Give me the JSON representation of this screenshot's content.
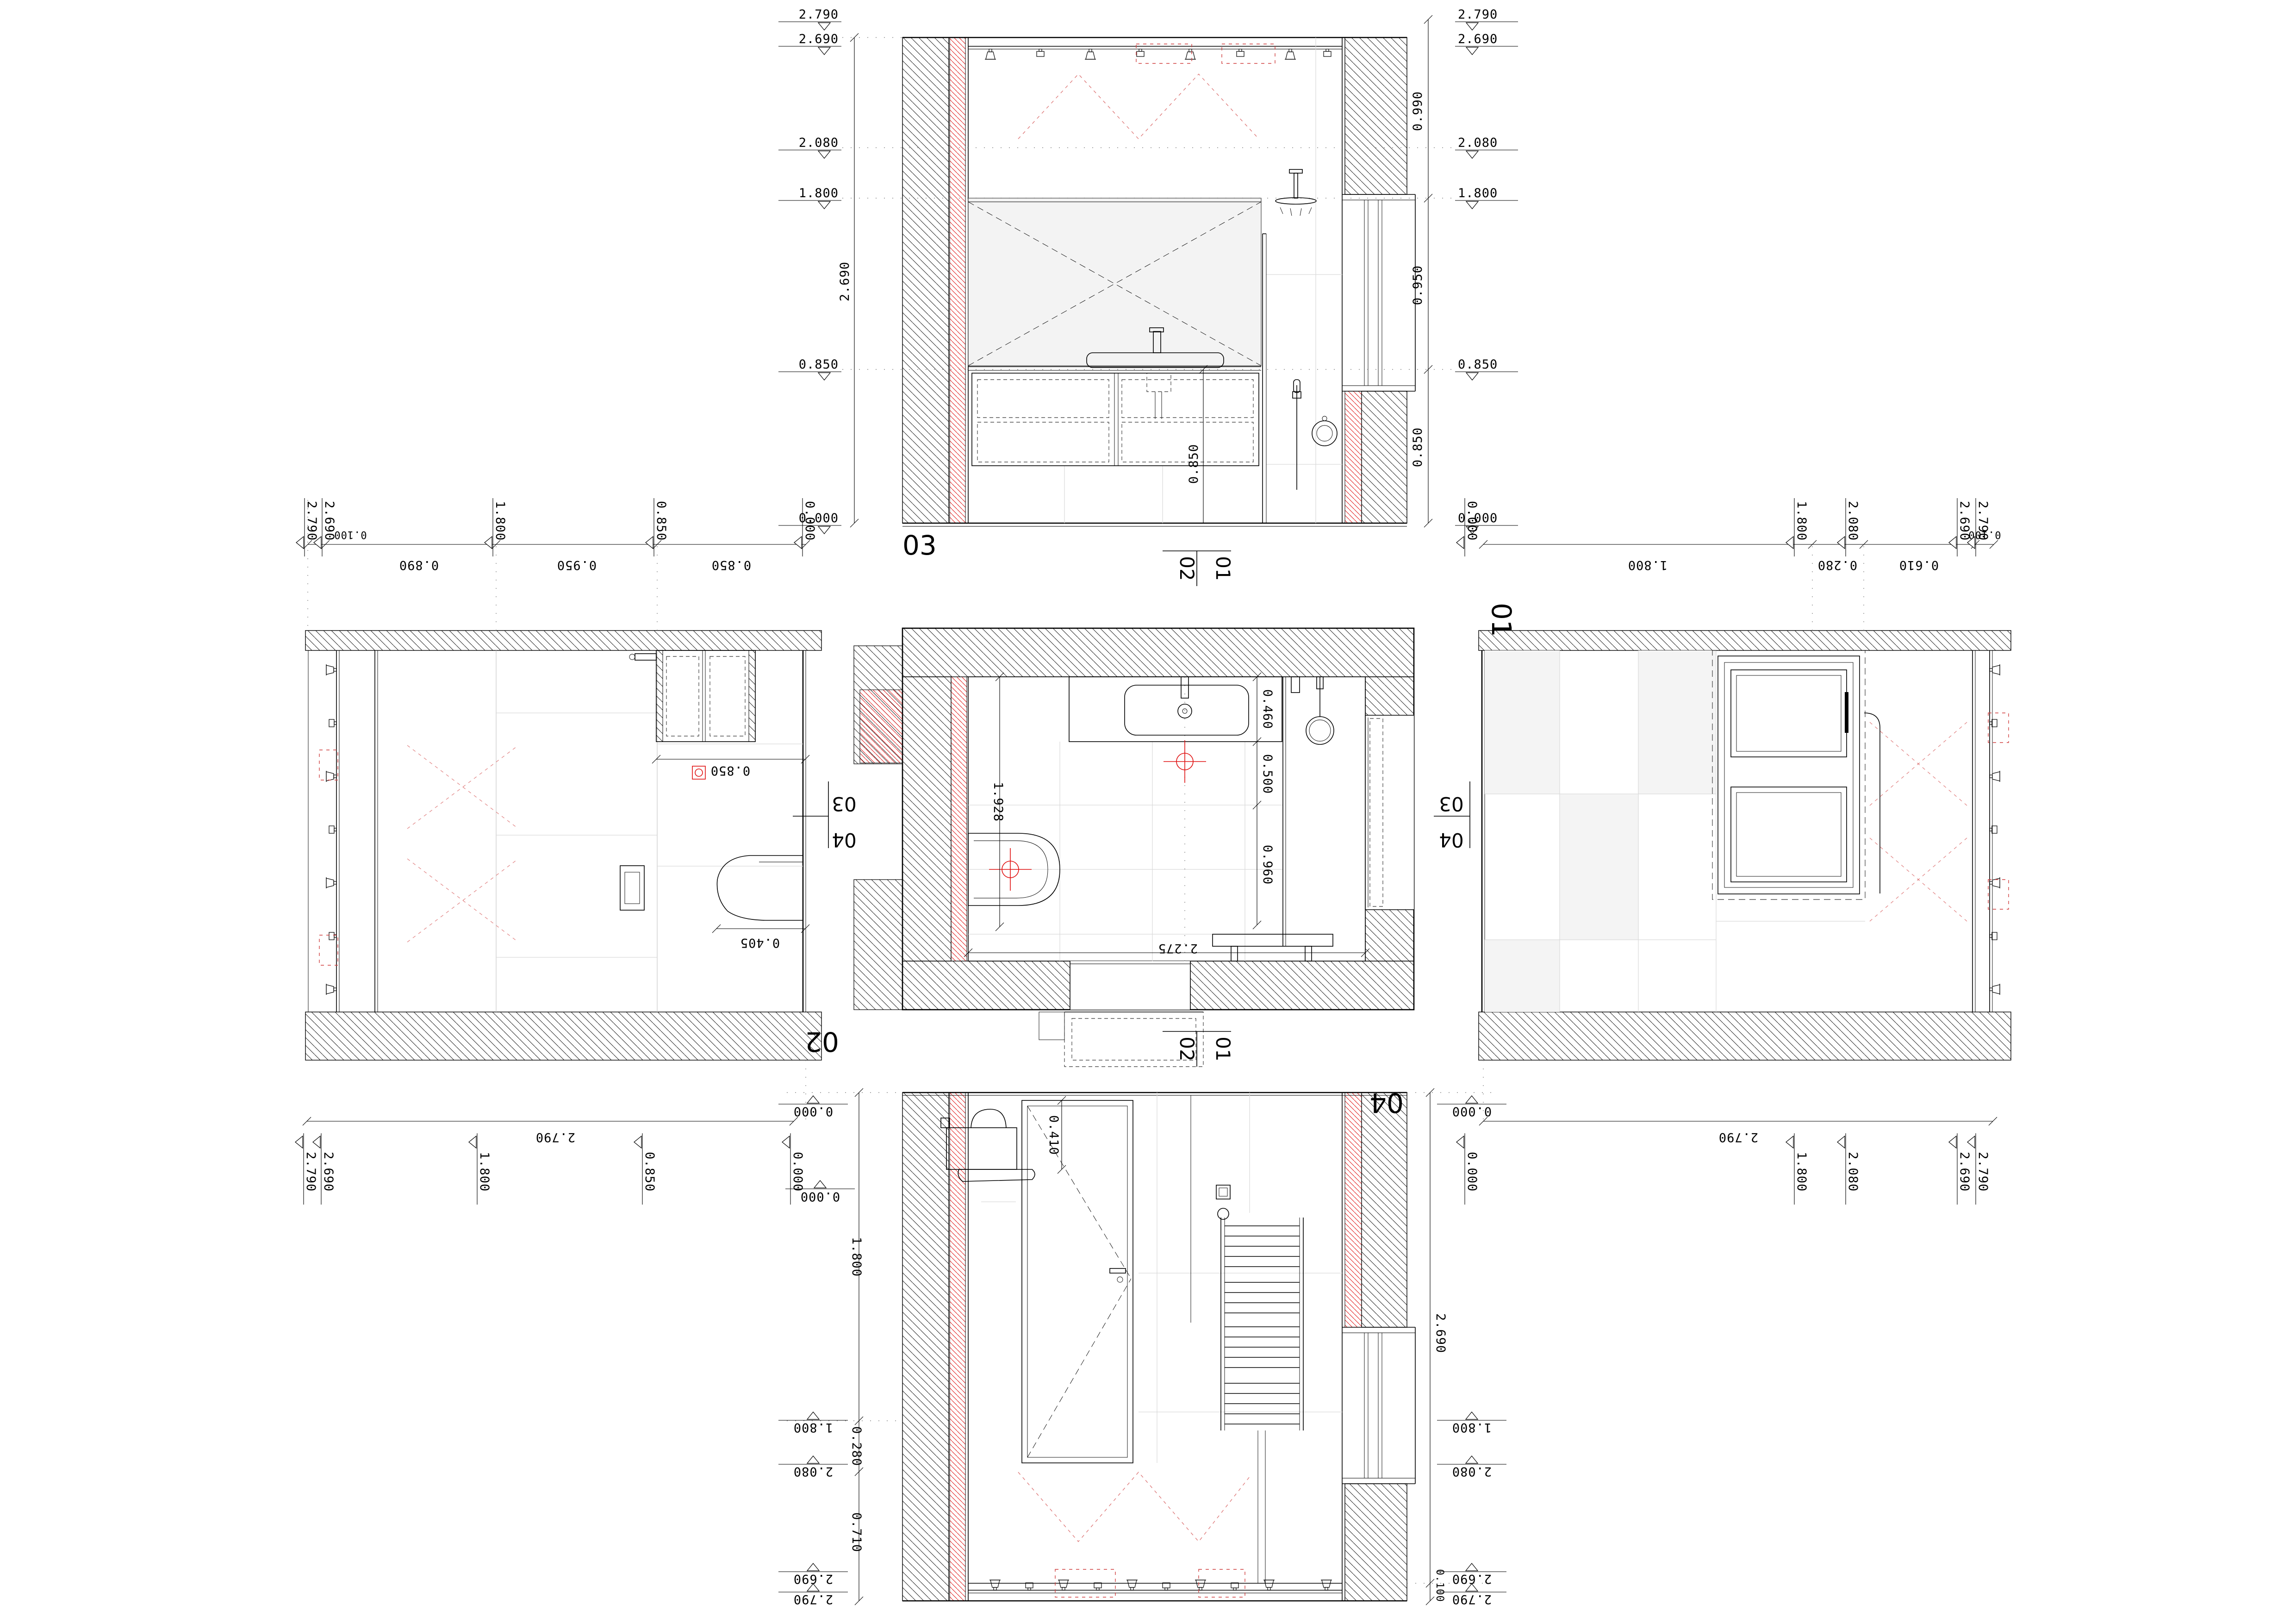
{
  "drawing": {
    "type": "bathroom floor plan with fold-out interior elevations",
    "colors": {
      "accent_red": "#e01010",
      "line_black": "#000000",
      "tile_joint": "#d9d9d9",
      "glass_fill": "#f3f3f3"
    }
  },
  "views": {
    "v03": {
      "label": "03",
      "left_levels": [
        "2.790",
        "2.690",
        "2.080",
        "1.800",
        "0.850",
        "0.000"
      ],
      "right_levels": [
        "2.790",
        "2.690",
        "2.080",
        "1.800",
        "0.850",
        "0.000"
      ],
      "height_dim": "2.690",
      "right_chain": [
        "0.990",
        "0.950",
        "0.850"
      ],
      "shower_dim": "0.850"
    },
    "plan": {
      "depth_chain": [
        "0.460",
        "0.500",
        "0.960"
      ],
      "wc_axis_dim": "1.928",
      "width_dim": "2.275",
      "floor_level": "0.000",
      "marker_h": [
        "02",
        "01"
      ],
      "marker_v": [
        "03",
        "04"
      ]
    },
    "v02": {
      "label": "02",
      "offset_dim": "0.100",
      "top_chain": [
        "0.890",
        "0.950",
        "0.850"
      ],
      "top_levels": [
        "2.790",
        "2.690",
        "1.800",
        "0.850",
        "0.000"
      ],
      "bottom_levels": [
        "2.790",
        "2.690",
        "1.800",
        "0.850",
        "0.000"
      ],
      "width_dim": "2.790",
      "vanity_dim": "0.850",
      "wc_dim": "0.405"
    },
    "v01": {
      "label": "01",
      "offset_dim": "0.100",
      "top_chain": [
        "1.800",
        "0.280",
        "0.610"
      ],
      "top_levels": [
        "0.000",
        "1.800",
        "2.080",
        "2.690",
        "2.790"
      ],
      "bottom_levels": [
        "0.000",
        "1.800",
        "2.080",
        "2.690",
        "2.790"
      ],
      "width_dim": "2.790"
    },
    "v04": {
      "label": "04",
      "left_chain": [
        "1.800",
        "0.280",
        "0.710"
      ],
      "left_levels": [
        "0.000",
        "1.800",
        "2.080",
        "2.690",
        "2.790"
      ],
      "right_levels": [
        "0.000",
        "1.800",
        "2.080",
        "2.690",
        "2.790"
      ],
      "height_dim": "2.690",
      "offset_dim": "0.100",
      "door_dim": "0.410"
    }
  }
}
